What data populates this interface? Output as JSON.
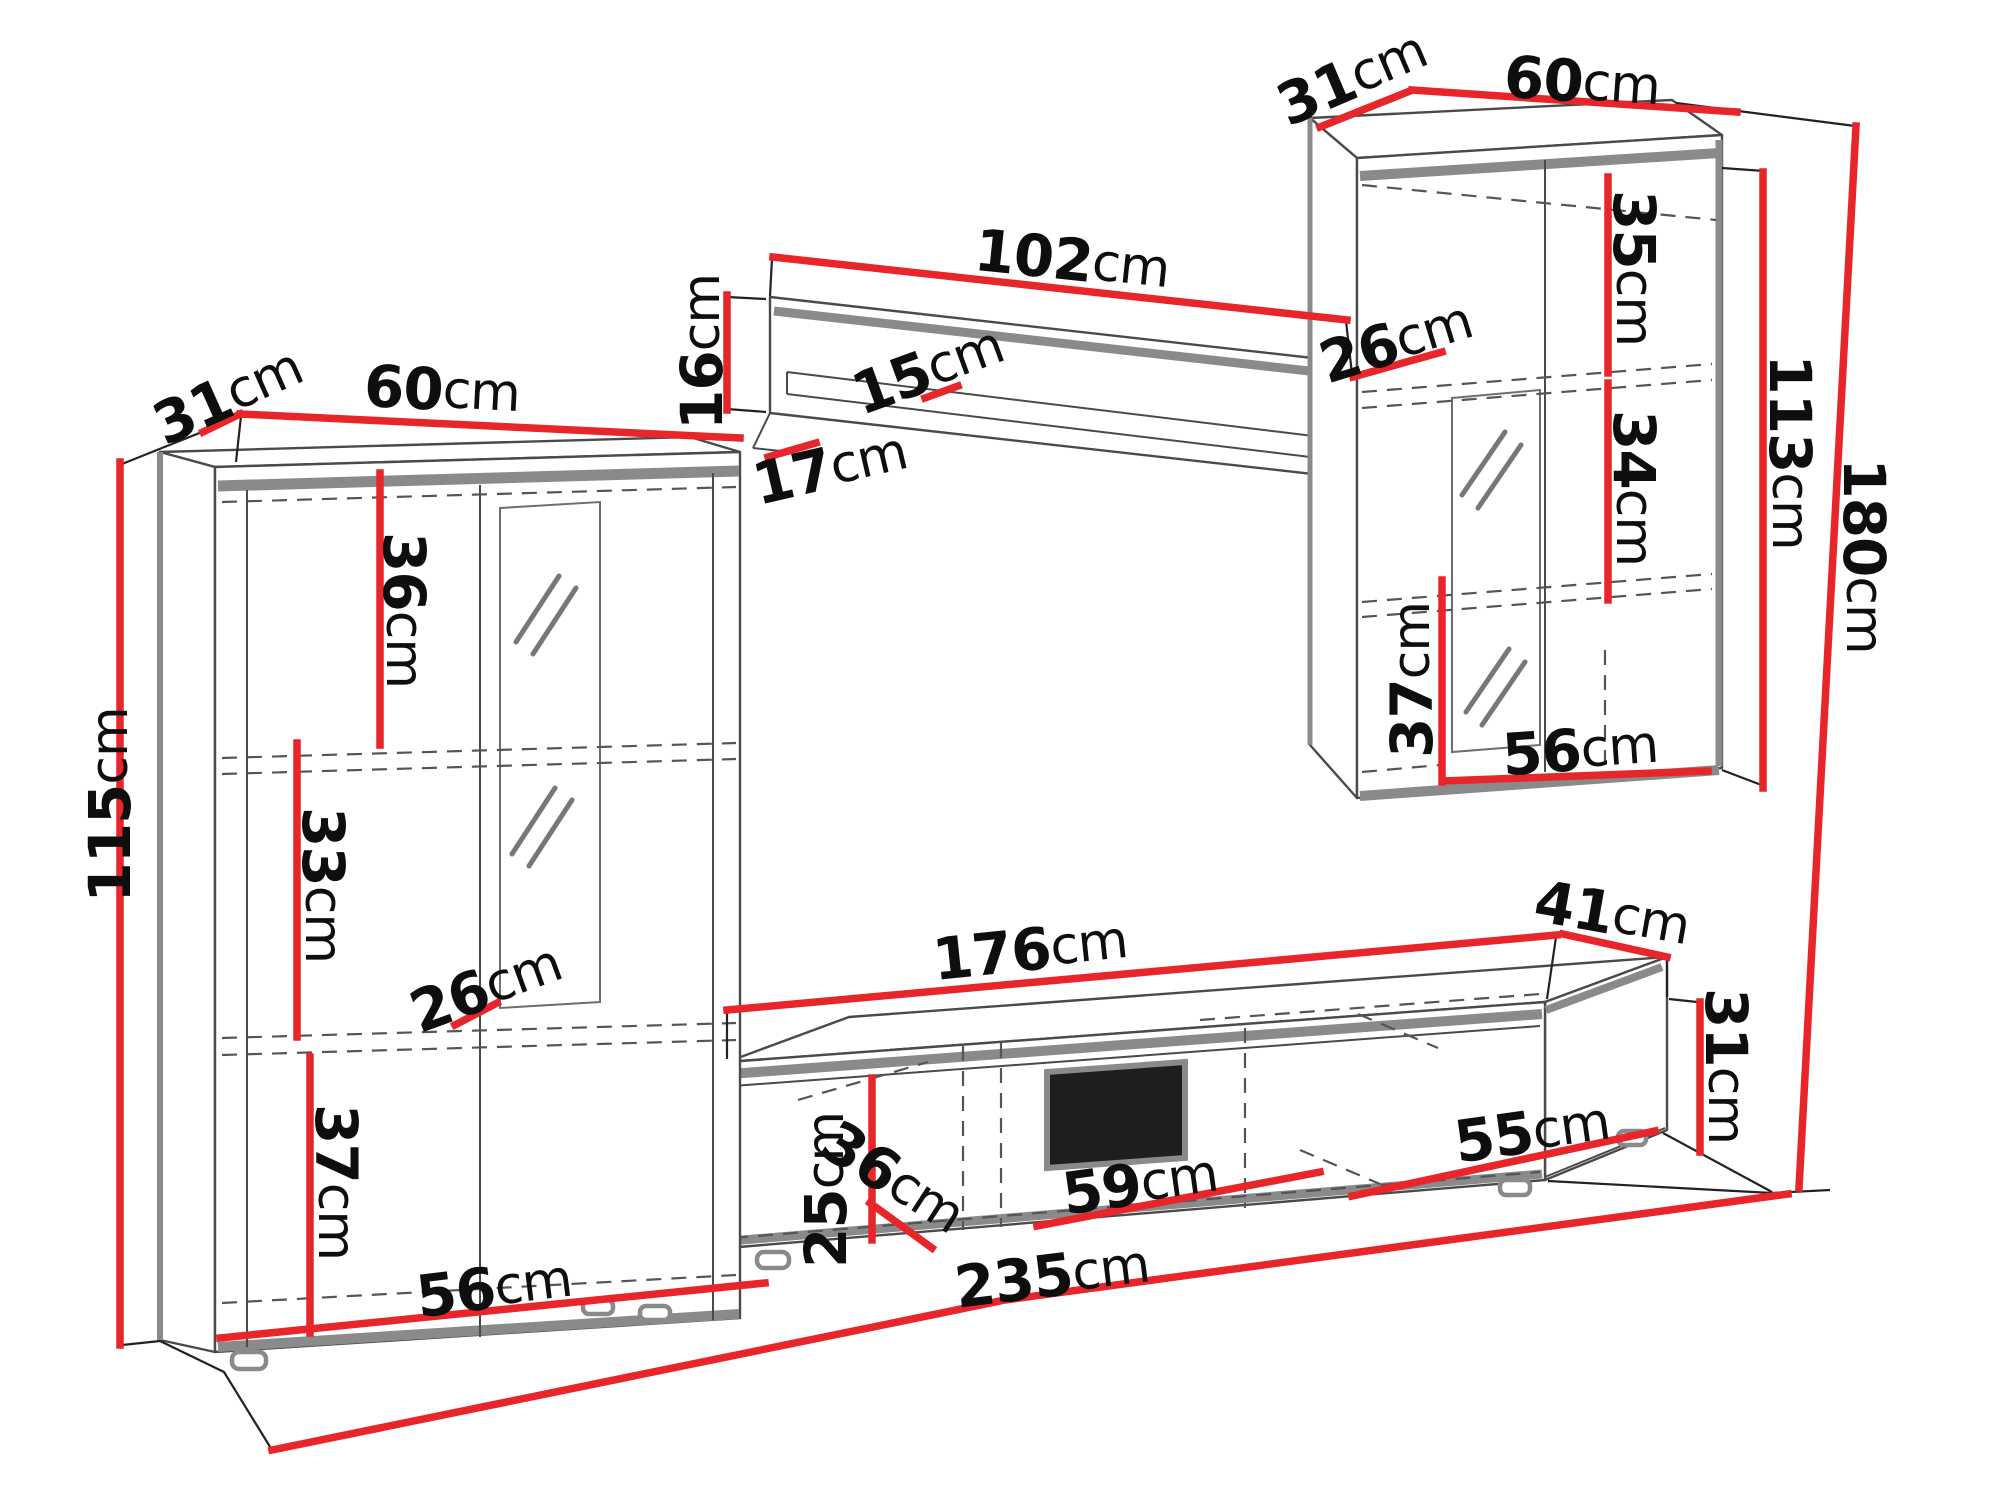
{
  "unit": "cm",
  "colors": {
    "dimension": "#e8252a",
    "outline": "#4a4a4a",
    "edge": "#8a8a8a",
    "text": "#0e0e0e",
    "background": "#ffffff"
  },
  "left_cabinet": {
    "depth": "31",
    "width": "60",
    "height": "115",
    "upper_section": "36",
    "middle_section": "33",
    "shelf_depth": "26",
    "lower_section": "37",
    "base_width": "56"
  },
  "wall_shelf": {
    "length": "102",
    "height": "16",
    "board_depth": "15",
    "side_depth": "17"
  },
  "hanging_cabinet": {
    "depth": "31",
    "width": "60",
    "shelf_depth": "26",
    "upper_section": "35",
    "middle_section": "34",
    "lower_section": "37",
    "base_width": "56",
    "body_height": "113",
    "total_height": "180"
  },
  "tv_stand": {
    "top_length": "176",
    "depth": "41",
    "height": "31",
    "inner_height": "25",
    "inner_depth": "36",
    "niche_width": "59",
    "right_compartment": "55",
    "total_width": "235"
  }
}
